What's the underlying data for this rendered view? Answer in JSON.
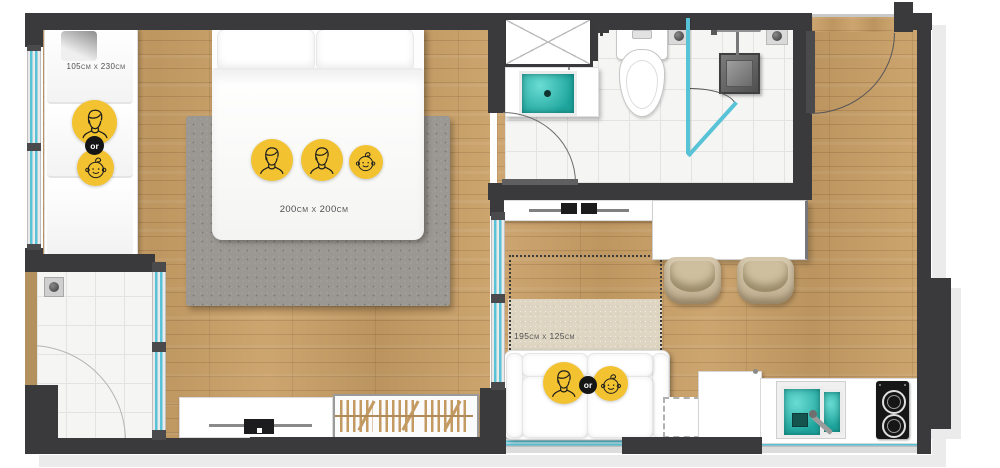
{
  "type": "apartment-floor-plan",
  "labels": {
    "sofa_small": "105cm x 230cm",
    "bed": "200cm x 200cm",
    "sofa_living": "195cm x 125cm",
    "or": "or"
  },
  "occupancy": {
    "bedroom_sofa_bed": [
      "adult",
      "or",
      "baby"
    ],
    "double_bed": [
      "adult",
      "adult",
      "baby"
    ],
    "living_sofa_bed": [
      "adult",
      "or",
      "baby"
    ]
  },
  "icons": {
    "adult": "adult-face-icon",
    "baby": "baby-face-icon",
    "or_badge": "or-badge"
  },
  "colors": {
    "accent": "#F2C230",
    "wall": "#3A3A3C",
    "glass": "#58C2D6",
    "water": "#2BB5AC",
    "wood": "#C99F66",
    "tile": "#F5F5F4",
    "rug_gray": "#9B9792",
    "rug_beige": "#DED6C2"
  },
  "rooms": [
    "bedroom",
    "bathroom",
    "living-kitchen",
    "entry-hall",
    "balcony"
  ],
  "fixtures": [
    "double-bed",
    "bedroom-sofa-bed",
    "living-sofa-bed",
    "wardrobe",
    "tv-console-bedroom",
    "tv-console-living",
    "bathroom-vanity-sink",
    "mirror-cabinet",
    "toilet",
    "shower",
    "dining-table",
    "dining-chairs",
    "kitchen-sink",
    "cooktop",
    "kitchen-cabinet",
    "balcony-drain"
  ]
}
